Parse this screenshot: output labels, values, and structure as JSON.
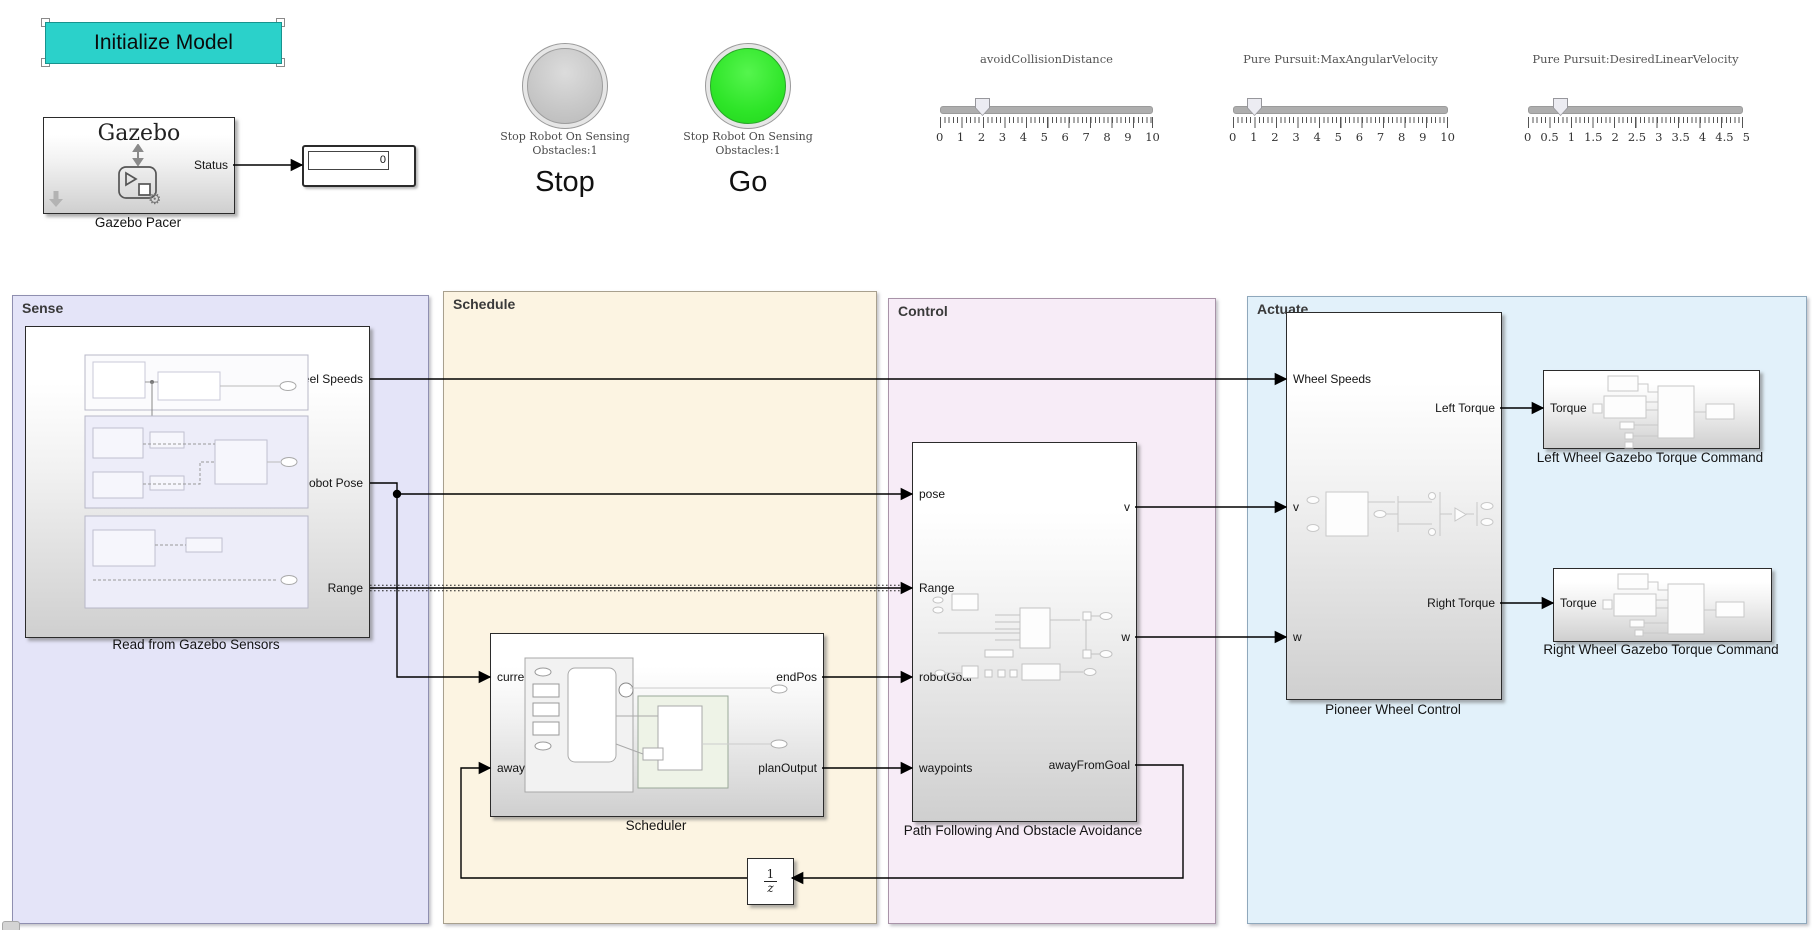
{
  "colors": {
    "button_cyan": "#2bd1ca",
    "lamp_off_gray": "#c6c6c6",
    "lamp_on_green": "#2ee528",
    "sense_bg": "#e4e4f8",
    "schedule_bg": "#fcf4e2",
    "control_bg": "#f7ecf7",
    "actuate_bg": "#e2f1fa"
  },
  "top": {
    "init_button_label": "Initialize Model",
    "gazebo_pacer": {
      "title": "Gazebo",
      "out_port": "Status",
      "caption": "Gazebo Pacer"
    },
    "status_display": {
      "value": "0"
    },
    "lamps": [
      {
        "caption_line1": "Stop Robot On Sensing",
        "caption_line2": "Obstacles:1",
        "label": "Stop",
        "state": "off"
      },
      {
        "caption_line1": "Stop Robot On Sensing",
        "caption_line2": "Obstacles:1",
        "label": "Go",
        "state": "on"
      }
    ],
    "sliders": [
      {
        "title": "avoidCollisionDistance",
        "min": 0,
        "max": 10,
        "value": 2,
        "ticks": [
          "0",
          "1",
          "2",
          "3",
          "4",
          "5",
          "6",
          "7",
          "8",
          "9",
          "10"
        ]
      },
      {
        "title": "Pure Pursuit:MaxAngularVelocity",
        "min": 0,
        "max": 10,
        "value": 1,
        "ticks": [
          "0",
          "1",
          "2",
          "3",
          "4",
          "5",
          "6",
          "7",
          "8",
          "9",
          "10"
        ]
      },
      {
        "title": "Pure Pursuit:DesiredLinearVelocity",
        "min": 0,
        "max": 5,
        "value": 0.75,
        "ticks": [
          "0",
          "0.5",
          "1",
          "1.5",
          "2",
          "2.5",
          "3",
          "3.5",
          "4",
          "4.5",
          "5"
        ]
      }
    ]
  },
  "areas": [
    {
      "label": "Sense"
    },
    {
      "label": "Schedule"
    },
    {
      "label": "Control"
    },
    {
      "label": "Actuate"
    }
  ],
  "blocks": {
    "read_gazebo": {
      "caption": "Read from Gazebo Sensors",
      "outputs": [
        "Wheel Speeds",
        "Robot Pose",
        "Range"
      ]
    },
    "scheduler": {
      "caption": "Scheduler",
      "inputs": [
        "currentPose",
        "awayFromGoal"
      ],
      "outputs": [
        "endPos",
        "planOutput"
      ]
    },
    "path_following": {
      "caption": "Path Following And Obstacle Avoidance",
      "inputs": [
        "pose",
        "Range",
        "robotGoal",
        "waypoints"
      ],
      "outputs": [
        "v",
        "w",
        "awayFromGoal"
      ]
    },
    "pioneer": {
      "caption": "Pioneer Wheel Control",
      "inputs": [
        "Wheel Speeds",
        "v",
        "w"
      ],
      "outputs": [
        "Left Torque",
        "Right Torque"
      ]
    },
    "left_wheel": {
      "caption": "Left Wheel Gazebo Torque Command",
      "inputs": [
        "Torque"
      ]
    },
    "right_wheel": {
      "caption": "Right Wheel Gazebo Torque Command",
      "inputs": [
        "Torque"
      ]
    },
    "unit_delay": {
      "numerator": "1",
      "denominator": "z"
    }
  }
}
